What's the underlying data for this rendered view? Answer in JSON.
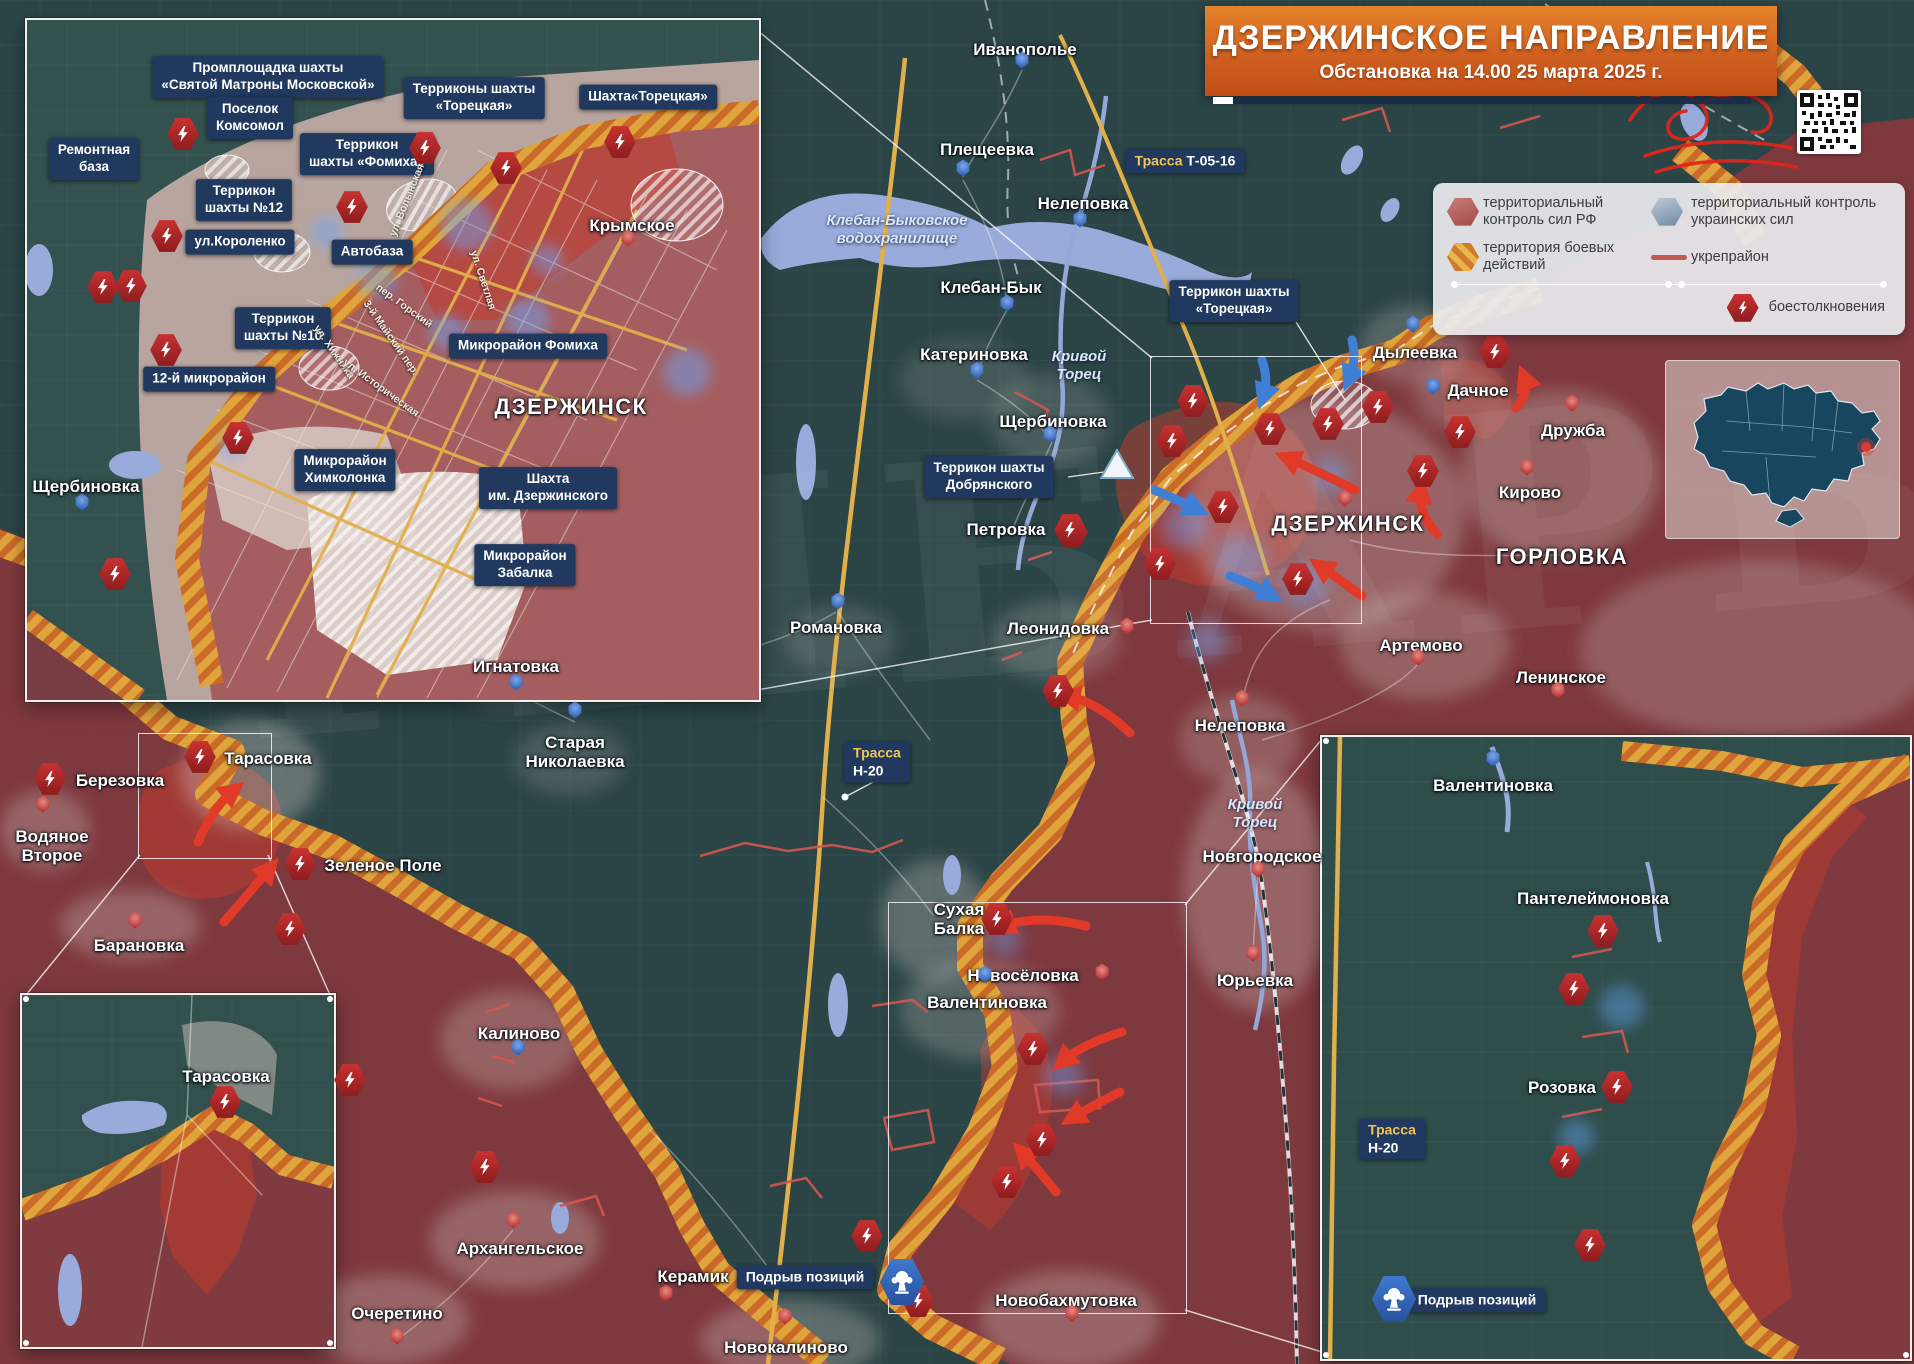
{
  "title": {
    "heading": "ДЗЕРЖИНСКОЕ НАПРАВЛЕНИЕ",
    "subtitle": "Обстановка на 14.00 25 марта 2025 г."
  },
  "legend": {
    "rf": "территориальный контроль сил РФ",
    "ua": "территориальный контроль украинских сил",
    "combat": "территория боевых действий",
    "fort": "укрепрайон",
    "clash": "боестолкновения"
  },
  "colors": {
    "rf_zone": "#8a383e",
    "assault": "#c33b2c",
    "combat_stripe1": "#e8b54a",
    "combat_stripe2": "#cf7a2e",
    "ua_zone": "#2b4547",
    "water": "#98abdb",
    "road": "#e2b04a",
    "label_box": "#21395e",
    "clash_icon": "#c93231",
    "ua_marker": "#2d5fb4",
    "rf_marker": "#b22f2e"
  },
  "demolition_label": "Подрыв позиций",
  "towns": [
    {
      "text": "Иванополье",
      "x": 1025,
      "y": 40
    },
    {
      "text": "Плещеевка",
      "x": 987,
      "y": 140
    },
    {
      "text": "Нелеповка",
      "x": 1083,
      "y": 194
    },
    {
      "text": "Клебан-Бык",
      "x": 991,
      "y": 278
    },
    {
      "text": "Катериновка",
      "x": 974,
      "y": 345
    },
    {
      "text": "Щербиновка",
      "x": 1053,
      "y": 412
    },
    {
      "text": "Петровка",
      "x": 1006,
      "y": 520
    },
    {
      "text": "Романовка",
      "x": 836,
      "y": 618
    },
    {
      "text": "Игнатовка",
      "x": 516,
      "y": 657
    },
    {
      "text": "Старая\nНиколаевка",
      "x": 575,
      "y": 733
    },
    {
      "text": "Калиново",
      "x": 519,
      "y": 1024
    },
    {
      "text": "Леонидовка",
      "x": 1058,
      "y": 619
    },
    {
      "text": "Нелеповка",
      "x": 1240,
      "y": 716
    },
    {
      "text": "Новгородское",
      "x": 1262,
      "y": 847
    },
    {
      "text": "Юрьевка",
      "x": 1255,
      "y": 971
    },
    {
      "text": "Новосёловка",
      "x": 1023,
      "y": 966
    },
    {
      "text": "Артемово",
      "x": 1421,
      "y": 636
    },
    {
      "text": "Ленинское",
      "x": 1561,
      "y": 668
    },
    {
      "text": "Дылеевка",
      "x": 1415,
      "y": 343
    },
    {
      "text": "Дачное",
      "x": 1478,
      "y": 381
    },
    {
      "text": "Дружба",
      "x": 1573,
      "y": 421
    },
    {
      "text": "Кирово",
      "x": 1530,
      "y": 483
    },
    {
      "text": "ДЗЕРЖИНСК",
      "x": 1348,
      "y": 512,
      "cls": "lg"
    },
    {
      "text": "ГОРЛОВКА",
      "x": 1562,
      "y": 545,
      "cls": "lg"
    },
    {
      "text": "Тарасовка",
      "x": 268,
      "y": 749
    },
    {
      "text": "Березовка",
      "x": 120,
      "y": 771
    },
    {
      "text": "Водяное\nВторое",
      "x": 52,
      "y": 827
    },
    {
      "text": "Зеленое Поле",
      "x": 383,
      "y": 856
    },
    {
      "text": "Барановка",
      "x": 139,
      "y": 936
    },
    {
      "text": "Архангельское",
      "x": 520,
      "y": 1239
    },
    {
      "text": "Очеретино",
      "x": 397,
      "y": 1304
    },
    {
      "text": "Новокалиново",
      "x": 786,
      "y": 1338
    },
    {
      "text": "Керамик",
      "x": 693,
      "y": 1267
    },
    {
      "text": "Новобахмутовка",
      "x": 1066,
      "y": 1291
    },
    {
      "text": "Сухая\nБалка",
      "x": 959,
      "y": 900
    },
    {
      "text": "Валентиновка",
      "x": 987,
      "y": 993
    },
    {
      "text": "Валентиновка",
      "x": 1493,
      "y": 776
    },
    {
      "text": "Пантелеймоновка",
      "x": 1593,
      "y": 889
    },
    {
      "text": "Розовка",
      "x": 1562,
      "y": 1078
    },
    {
      "text": "Щербиновка",
      "x": 86,
      "y": 477
    },
    {
      "text": "ДЗЕРЖИНСК",
      "x": 571,
      "y": 395,
      "cls": "lg"
    },
    {
      "text": "Крымское",
      "x": 632,
      "y": 216
    },
    {
      "text": "Тарасовка",
      "x": 226,
      "y": 1067
    }
  ],
  "water_labels": [
    {
      "text": "Клебан-Быковское\nводохранилище",
      "x": 897,
      "y": 212
    },
    {
      "text": "Кривой\nТорец",
      "x": 1079,
      "y": 348
    },
    {
      "text": "Кривой\nТорец",
      "x": 1255,
      "y": 796
    }
  ],
  "callouts": [
    {
      "text": "Промплощадка шахты\n«Святой Матроны Московской»",
      "x": 268,
      "y": 77
    },
    {
      "text": "Поселок\nКомсомол",
      "x": 250,
      "y": 118
    },
    {
      "text": "Ремонтная\nбаза",
      "x": 94,
      "y": 159
    },
    {
      "text": "Террикон\nшахты №12",
      "x": 244,
      "y": 200
    },
    {
      "text": "Террикон\nшахты «Фомиха»",
      "x": 367,
      "y": 154
    },
    {
      "text": "Терриконы шахты\n«Торецкая»",
      "x": 474,
      "y": 98
    },
    {
      "text": "Шахта«Торецкая»",
      "x": 648,
      "y": 97
    },
    {
      "text": "ул.Короленко",
      "x": 240,
      "y": 242
    },
    {
      "text": "Автобаза",
      "x": 372,
      "y": 252
    },
    {
      "text": "Террикон\nшахты №10",
      "x": 283,
      "y": 328
    },
    {
      "text": "12-й микрорайон",
      "x": 209,
      "y": 379
    },
    {
      "text": "Микрорайон Фомиха",
      "x": 528,
      "y": 346
    },
    {
      "text": "Микрорайон\nХимколонка",
      "x": 345,
      "y": 470
    },
    {
      "text": "Шахта\nим. Дзержинского",
      "x": 548,
      "y": 488
    },
    {
      "text": "Микрорайон\nЗабалка",
      "x": 525,
      "y": 565
    },
    {
      "text": "Террикон шахты\n«Торецкая»",
      "x": 1234,
      "y": 301
    },
    {
      "text": "Террикон шахты\nДобрянского",
      "x": 989,
      "y": 477
    }
  ],
  "streets": [
    {
      "text": "ул. Волынская",
      "x": 407,
      "y": 200,
      "rot": -68
    },
    {
      "text": "ул. Светлая",
      "x": 483,
      "y": 280,
      "rot": 72
    },
    {
      "text": "пер. Горский",
      "x": 404,
      "y": 306,
      "rot": 36
    },
    {
      "text": "3-й Майский пер.",
      "x": 391,
      "y": 338,
      "rot": 55
    },
    {
      "text": "ул. Хижняка",
      "x": 334,
      "y": 352,
      "rot": 55
    },
    {
      "text": "ул. Историческая",
      "x": 381,
      "y": 388,
      "rot": 36
    }
  ],
  "road_badges": [
    {
      "t1": "Трасса",
      "t2": "Т-05-16",
      "x": 1185,
      "y": 161,
      "two": false
    },
    {
      "t1": "Трасса",
      "t2": "Н-20",
      "x": 877,
      "y": 762,
      "two": true
    },
    {
      "t1": "Трасса",
      "t2": "Н-20",
      "x": 1392,
      "y": 1139,
      "two": true
    }
  ],
  "demolitions": [
    {
      "tx": 805,
      "ty": 1277,
      "ix": 902,
      "iy": 1282
    },
    {
      "tx": 1477,
      "ty": 1300,
      "ix": 1394,
      "iy": 1299
    }
  ],
  "markers": [
    {
      "x": 1022,
      "y": 60,
      "c": "b"
    },
    {
      "x": 963,
      "y": 168,
      "c": "b"
    },
    {
      "x": 1080,
      "y": 219,
      "c": "b"
    },
    {
      "x": 1007,
      "y": 303,
      "c": "b"
    },
    {
      "x": 977,
      "y": 370,
      "c": "b"
    },
    {
      "x": 1050,
      "y": 434,
      "c": "b"
    },
    {
      "x": 838,
      "y": 601,
      "c": "b"
    },
    {
      "x": 516,
      "y": 682,
      "c": "b"
    },
    {
      "x": 575,
      "y": 710,
      "c": "b"
    },
    {
      "x": 518,
      "y": 1047,
      "c": "b"
    },
    {
      "x": 1413,
      "y": 324,
      "c": "b"
    },
    {
      "x": 1433,
      "y": 386,
      "c": "b"
    },
    {
      "x": 985,
      "y": 974,
      "c": "b"
    },
    {
      "x": 1493,
      "y": 758,
      "c": "b"
    },
    {
      "x": 82,
      "y": 502,
      "c": "b"
    },
    {
      "x": 1127,
      "y": 626,
      "c": "r"
    },
    {
      "x": 1242,
      "y": 698,
      "c": "r"
    },
    {
      "x": 1258,
      "y": 869,
      "c": "r"
    },
    {
      "x": 1253,
      "y": 953,
      "c": "r"
    },
    {
      "x": 1102,
      "y": 972,
      "c": "r"
    },
    {
      "x": 1418,
      "y": 657,
      "c": "r"
    },
    {
      "x": 1558,
      "y": 690,
      "c": "r"
    },
    {
      "x": 1572,
      "y": 403,
      "c": "r"
    },
    {
      "x": 1527,
      "y": 467,
      "c": "r"
    },
    {
      "x": 1345,
      "y": 498,
      "c": "r"
    },
    {
      "x": 43,
      "y": 804,
      "c": "r"
    },
    {
      "x": 135,
      "y": 920,
      "c": "r"
    },
    {
      "x": 513,
      "y": 1220,
      "c": "r"
    },
    {
      "x": 397,
      "y": 1336,
      "c": "r"
    },
    {
      "x": 785,
      "y": 1316,
      "c": "r"
    },
    {
      "x": 666,
      "y": 1293,
      "c": "r"
    },
    {
      "x": 1072,
      "y": 1313,
      "c": "r"
    },
    {
      "x": 628,
      "y": 238,
      "c": "r"
    }
  ],
  "flashes": [
    {
      "x": 183,
      "y": 134
    },
    {
      "x": 425,
      "y": 148
    },
    {
      "x": 506,
      "y": 168
    },
    {
      "x": 620,
      "y": 142
    },
    {
      "x": 352,
      "y": 207
    },
    {
      "x": 167,
      "y": 236
    },
    {
      "x": 131,
      "y": 286
    },
    {
      "x": 103,
      "y": 287
    },
    {
      "x": 166,
      "y": 350
    },
    {
      "x": 238,
      "y": 438
    },
    {
      "x": 115,
      "y": 574
    },
    {
      "x": 1193,
      "y": 401
    },
    {
      "x": 1270,
      "y": 429
    },
    {
      "x": 1328,
      "y": 424
    },
    {
      "x": 1378,
      "y": 407
    },
    {
      "x": 1460,
      "y": 432
    },
    {
      "x": 1423,
      "y": 471
    },
    {
      "x": 1172,
      "y": 441
    },
    {
      "x": 1223,
      "y": 507
    },
    {
      "x": 1072,
      "y": 532
    },
    {
      "x": 1160,
      "y": 564
    },
    {
      "x": 1298,
      "y": 579
    },
    {
      "x": 1495,
      "y": 352
    },
    {
      "x": 1058,
      "y": 691
    },
    {
      "x": 1070,
      "y": 530
    },
    {
      "x": 997,
      "y": 919
    },
    {
      "x": 1033,
      "y": 1049
    },
    {
      "x": 1042,
      "y": 1140
    },
    {
      "x": 1007,
      "y": 1182
    },
    {
      "x": 867,
      "y": 1236
    },
    {
      "x": 918,
      "y": 1301
    },
    {
      "x": 200,
      "y": 757
    },
    {
      "x": 50,
      "y": 779
    },
    {
      "x": 300,
      "y": 864
    },
    {
      "x": 290,
      "y": 929
    },
    {
      "x": 350,
      "y": 1080
    },
    {
      "x": 485,
      "y": 1167
    },
    {
      "x": 225,
      "y": 1102
    },
    {
      "x": 1603,
      "y": 931
    },
    {
      "x": 1574,
      "y": 989
    },
    {
      "x": 1617,
      "y": 1087
    },
    {
      "x": 1565,
      "y": 1161
    },
    {
      "x": 1590,
      "y": 1245
    }
  ],
  "arrows": [
    {
      "d": "M 428,212 Q 416,182 430,158",
      "c": "r"
    },
    {
      "d": "M 500,252 Q 492,218 506,192",
      "c": "r"
    },
    {
      "d": "M 632,196 Q 621,172 633,152",
      "c": "r"
    },
    {
      "d": "M 388,516 Q 406,500 424,503",
      "c": "r"
    },
    {
      "d": "M 1355,490 Q 1320,472 1287,458",
      "c": "r"
    },
    {
      "d": "M 1437,534 Q 1417,512 1421,490",
      "c": "r"
    },
    {
      "d": "M 1516,408 Q 1530,392 1524,377",
      "c": "r"
    },
    {
      "d": "M 1130,733 Q 1098,702 1067,696",
      "c": "r"
    },
    {
      "d": "M 1362,596 Q 1336,577 1320,566",
      "c": "r"
    },
    {
      "d": "M 1086,926 Q 1040,914 1002,926",
      "c": "r"
    },
    {
      "d": "M 1122,1032 Q 1082,1044 1062,1062",
      "c": "r"
    },
    {
      "d": "M 1120,1092 Q 1092,1106 1072,1118",
      "c": "r"
    },
    {
      "d": "M 1056,1192 Q 1035,1166 1022,1152",
      "c": "r"
    },
    {
      "d": "M 198,842 Q 214,806 234,790",
      "c": "r"
    },
    {
      "d": "M 224,922 Q 250,892 270,868",
      "c": "r"
    },
    {
      "d": "M 224,1158 Q 214,1126 226,1098",
      "c": "r"
    },
    {
      "d": "M 1732,882 Q 1692,892 1663,906",
      "c": "r"
    },
    {
      "d": "M 1762,1006 Q 1722,1008 1692,1016",
      "c": "r"
    },
    {
      "d": "M 1707,1166 Q 1673,1148 1653,1132",
      "c": "r"
    },
    {
      "d": "M 1670,1268 Q 1641,1246 1626,1230",
      "c": "r"
    },
    {
      "d": "M 352,98 Q 384,104 406,122",
      "c": "b"
    },
    {
      "d": "M 542,112 Q 566,124 560,146",
      "c": "b"
    },
    {
      "d": "M 96,208 Q 116,214 130,228",
      "c": "b"
    },
    {
      "d": "M 60,270 Q 84,278 100,292",
      "c": "b"
    },
    {
      "d": "M 238,396 Q 258,402 272,406",
      "c": "b"
    },
    {
      "d": "M 94,520 Q 101,540 112,553",
      "c": "b"
    },
    {
      "d": "M 170,538 Q 181,554 190,566",
      "c": "b"
    },
    {
      "d": "M 1262,360 Q 1269,380 1263,397",
      "c": "b"
    },
    {
      "d": "M 1352,340 Q 1357,360 1349,379",
      "c": "b"
    },
    {
      "d": "M 1154,490 Q 1176,499 1197,509",
      "c": "b"
    },
    {
      "d": "M 1230,576 Q 1252,584 1271,595",
      "c": "b"
    }
  ]
}
